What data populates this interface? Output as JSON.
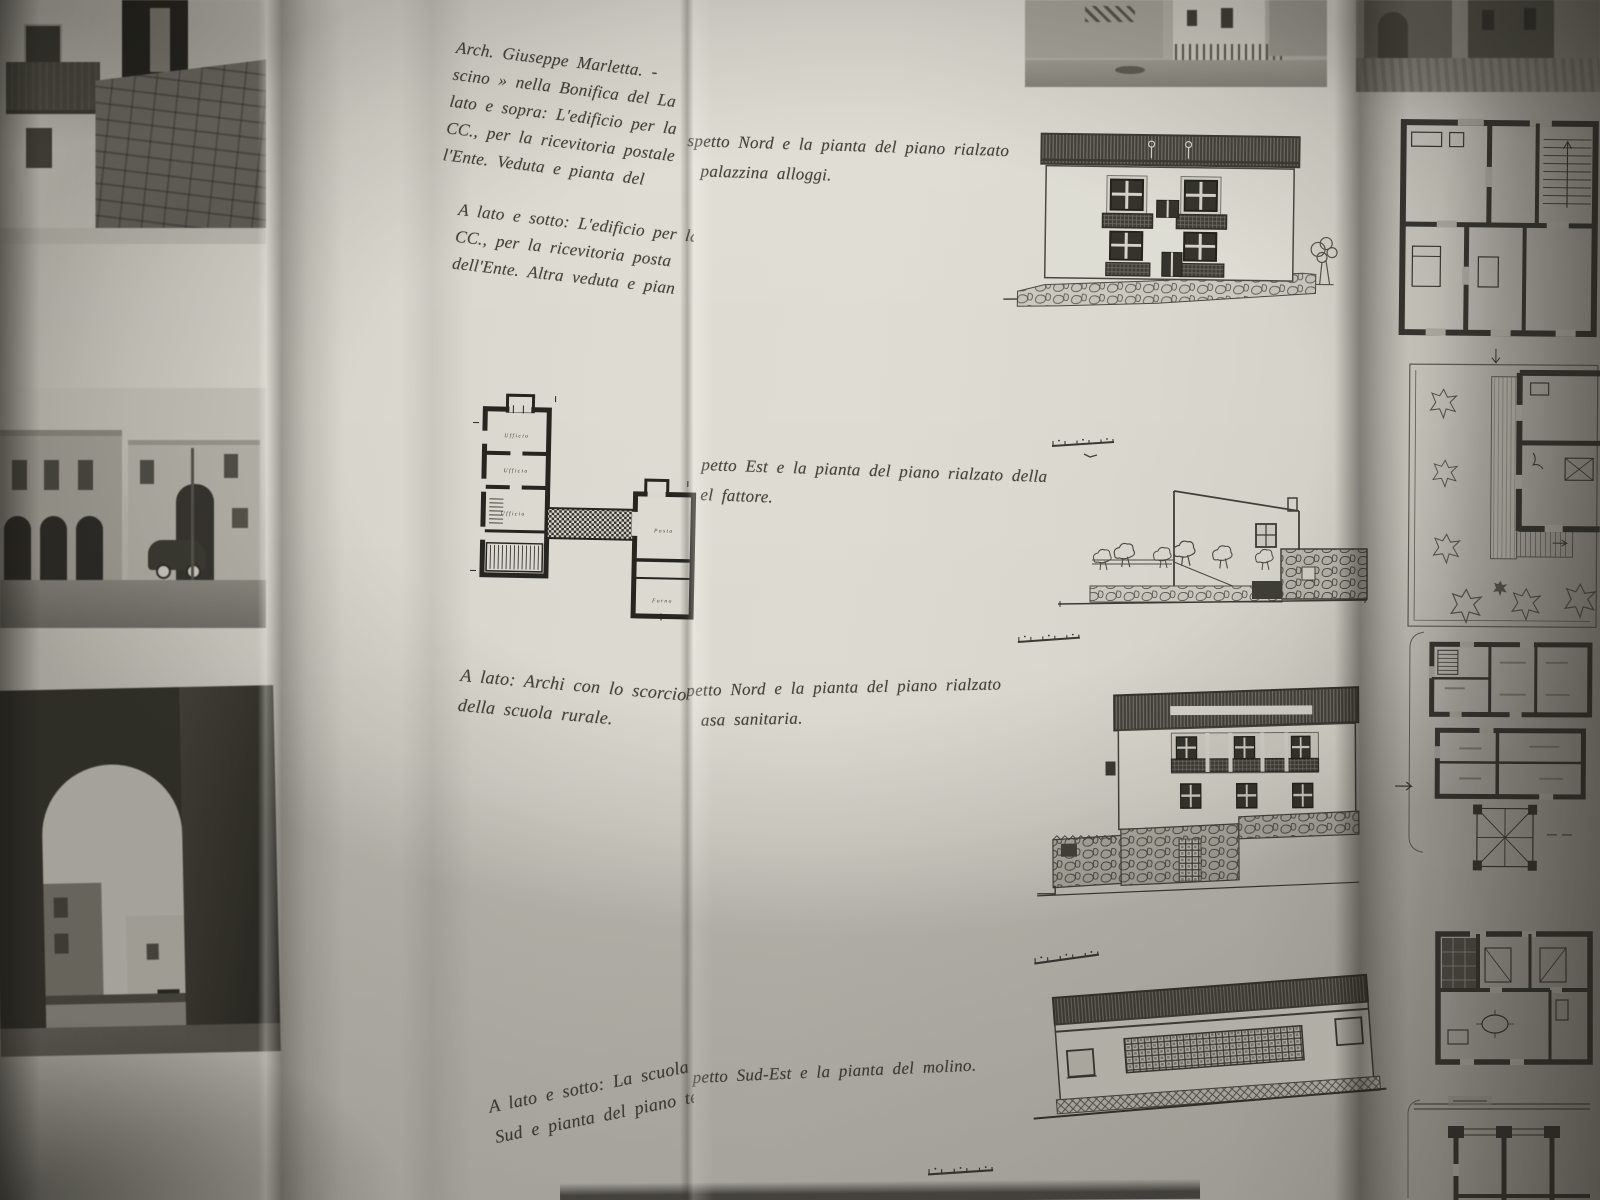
{
  "captions": {
    "credit_block": {
      "lines": [
        "Arch. Giuseppe Marletta. -",
        "scino » nella Bonifica del La",
        "lato e sopra: L'edificio per la",
        "CC., per la ricevitoria postale",
        "l'Ente. Veduta e pianta del"
      ]
    },
    "frag_nord_palazzina": {
      "lines": [
        "spetto Nord e la pianta del piano rialzato",
        "palazzina alloggi."
      ]
    },
    "lato_sotto_edificio": {
      "lines": [
        "A lato e sotto: L'edificio per la",
        "CC., per la ricevitoria posta",
        "dell'Ente. Altra veduta e pian"
      ]
    },
    "frag_est_fattore": {
      "lines": [
        "petto Est e la pianta del piano rialzato della",
        "el fattore."
      ]
    },
    "lato_archi": {
      "lines": [
        "A lato: Archi con lo scorcio",
        "della scuola rurale."
      ]
    },
    "frag_nord_sanitaria": {
      "lines": [
        "petto Nord e la pianta del piano rialzato",
        "asa sanitaria."
      ]
    },
    "frag_sudest_molino": {
      "lines": [
        "petto Sud-Est e la pianta del molino."
      ]
    },
    "lato_sotto_scuola": {
      "lines": [
        "A lato e sotto: La scuola",
        "Sud e pianta del piano ter"
      ]
    }
  },
  "plan_labels": {
    "room1": "Ufficio",
    "room2": "Ufficio",
    "room3": "Ufficio",
    "room4": "Posta",
    "room5": "Forno"
  },
  "colors": {
    "page": "#dedcd2",
    "ink": "#3c3b33",
    "plan_ink": "#26251f",
    "shadow": "#1a1913"
  }
}
